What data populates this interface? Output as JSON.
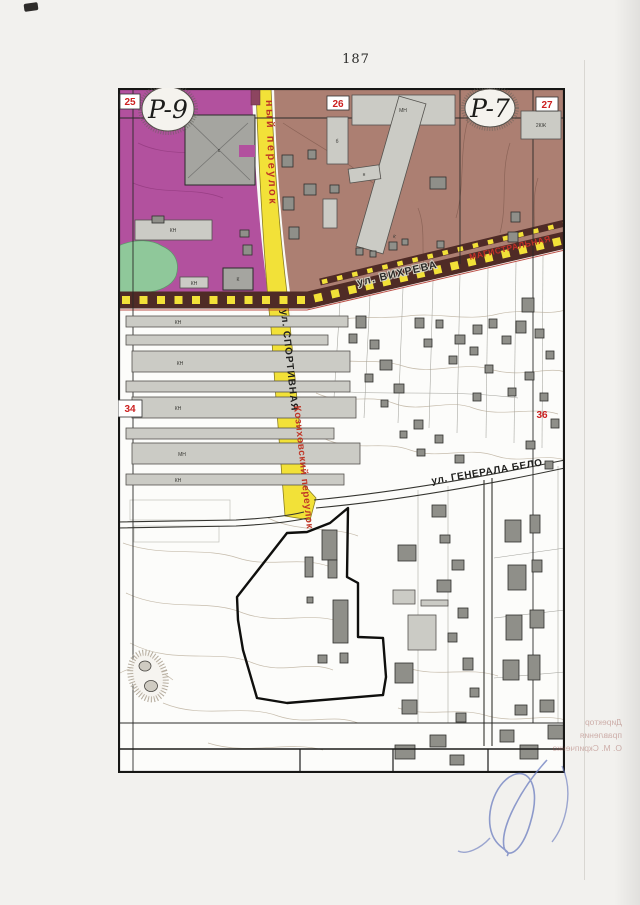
{
  "page": {
    "number": "187"
  },
  "map": {
    "zone_labels": [
      {
        "code": "P-9"
      },
      {
        "code": "P-7"
      }
    ],
    "grid_numbers": [
      {
        "value": "25"
      },
      {
        "value": "26"
      },
      {
        "value": "27"
      },
      {
        "value": "34"
      },
      {
        "value": "36"
      }
    ],
    "streets": {
      "top_lane": "ный переулок",
      "sportivnaya": "ул. СПОРТИВНАЯ",
      "kozikhovsky": "Козиховский переулок",
      "vikhreva": "ул. ВИХРЕВА",
      "vikhreva_red": "МАГИСТРАЛЬНАЯ",
      "belova": "ул. ГЕНЕРАЛА БЕЛО"
    },
    "building_labels": {
      "mn": "МН",
      "kn": "КН",
      "k": "К",
      "kzh2": "2КЖ",
      "b": "б",
      "n": "н",
      "s": "с"
    },
    "barracks": [
      {
        "label": "КН"
      },
      {
        "label": "КН"
      },
      {
        "label": "КН"
      },
      {
        "label": "МН"
      },
      {
        "label": "КН"
      }
    ],
    "colors": {
      "zone_p9": "#b2519e",
      "zone_p7": "#ac7f72",
      "green_area": "#8fc89a",
      "road_yellow": "#f2e138",
      "planned_road_band": "#4f2b26",
      "grid_number_red": "#cc2020"
    }
  },
  "annotations": {
    "show_through_lines": [
      "Директор",
      "правления",
      "О. М. Скрипченко"
    ]
  }
}
